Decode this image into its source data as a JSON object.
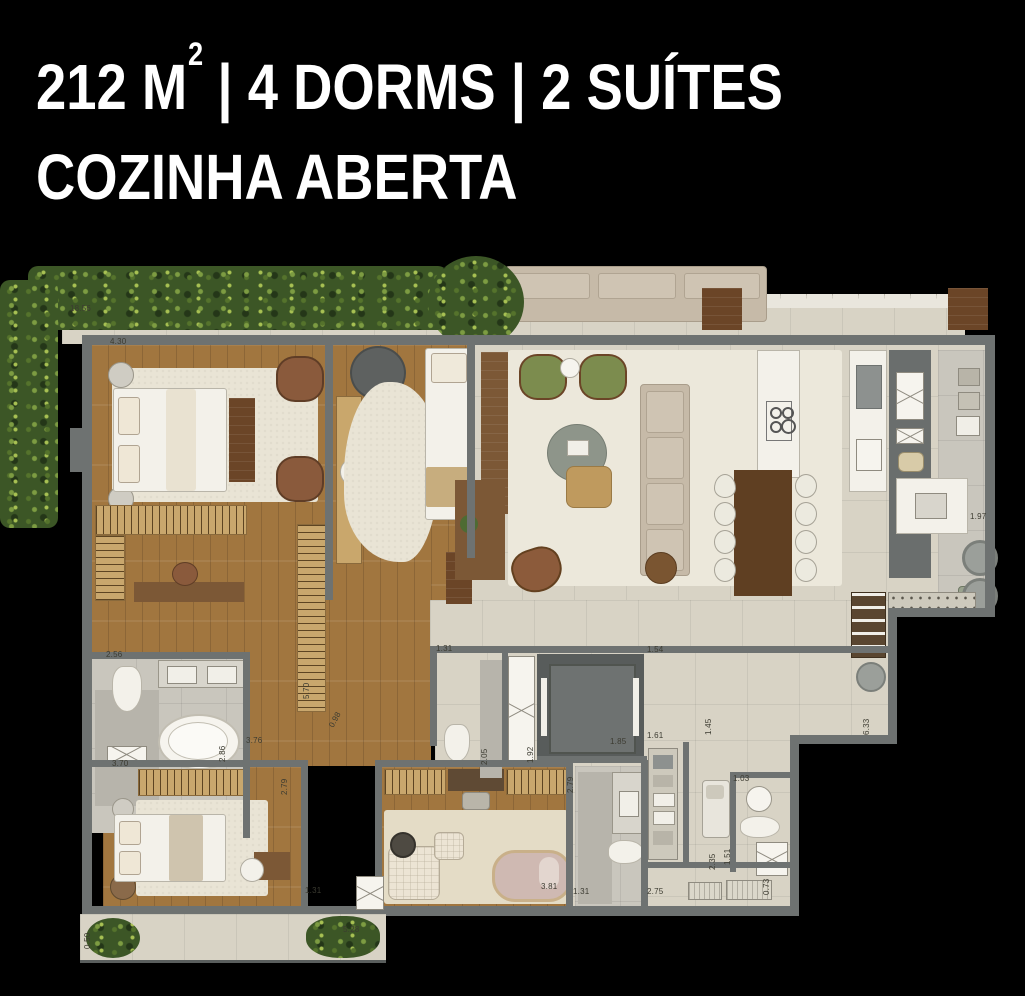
{
  "title": {
    "line1_prefix": "212 M",
    "line1_sup": "2",
    "line1_rest": " | 4 DORMS | 2 SUÍTES",
    "line2": "COZINHA ABERTA"
  },
  "colors": {
    "background": "#000000",
    "wall": "#6e7271",
    "wood_floor": "#a1763f",
    "tile_floor": "#d8d3c5",
    "hedge_green": "#3c5626",
    "accent_green_chair": "#7c8c4e"
  },
  "floorplan": {
    "dimensions": [
      {
        "text": "18.56",
        "x": 70,
        "y": 314,
        "rot": 0
      },
      {
        "text": "4.30",
        "x": 110,
        "y": 347,
        "rot": 0
      },
      {
        "text": "2.56",
        "x": 106,
        "y": 660,
        "rot": 0
      },
      {
        "text": "2.86",
        "x": 227,
        "y": 763,
        "rot": -90
      },
      {
        "text": "3.76",
        "x": 246,
        "y": 746,
        "rot": 0
      },
      {
        "text": "3.70",
        "x": 112,
        "y": 769,
        "rot": 0
      },
      {
        "text": "2.79",
        "x": 289,
        "y": 796,
        "rot": -90
      },
      {
        "text": "1.31",
        "x": 305,
        "y": 896,
        "rot": 0
      },
      {
        "text": "0.50",
        "x": 92,
        "y": 950,
        "rot": -90
      },
      {
        "text": "5.28",
        "x": 343,
        "y": 935,
        "rot": 0
      },
      {
        "text": "5.70",
        "x": 311,
        "y": 700,
        "rot": -90
      },
      {
        "text": "0.98",
        "x": 335,
        "y": 730,
        "rot": -62
      },
      {
        "text": "1.31",
        "x": 436,
        "y": 654,
        "rot": 0
      },
      {
        "text": "2.05",
        "x": 489,
        "y": 766,
        "rot": -90
      },
      {
        "text": "1.92",
        "x": 535,
        "y": 764,
        "rot": -90
      },
      {
        "text": "1.85",
        "x": 610,
        "y": 747,
        "rot": 0
      },
      {
        "text": "1.54",
        "x": 647,
        "y": 655,
        "rot": 0
      },
      {
        "text": "1.45",
        "x": 713,
        "y": 736,
        "rot": -90
      },
      {
        "text": "6.33",
        "x": 871,
        "y": 736,
        "rot": -90
      },
      {
        "text": "1.97",
        "x": 970,
        "y": 522,
        "rot": 0
      },
      {
        "text": "1.61",
        "x": 647,
        "y": 741,
        "rot": 0
      },
      {
        "text": "2.79",
        "x": 575,
        "y": 794,
        "rot": -90
      },
      {
        "text": "3.81",
        "x": 541,
        "y": 892,
        "rot": 0
      },
      {
        "text": "1.31",
        "x": 573,
        "y": 897,
        "rot": 0
      },
      {
        "text": "2.75",
        "x": 647,
        "y": 897,
        "rot": 0
      },
      {
        "text": "1.03",
        "x": 733,
        "y": 784,
        "rot": 0
      },
      {
        "text": "1.51",
        "x": 732,
        "y": 866,
        "rot": -90
      },
      {
        "text": "2.35",
        "x": 717,
        "y": 871,
        "rot": -90
      },
      {
        "text": "0.73",
        "x": 771,
        "y": 896,
        "rot": -90
      }
    ]
  }
}
